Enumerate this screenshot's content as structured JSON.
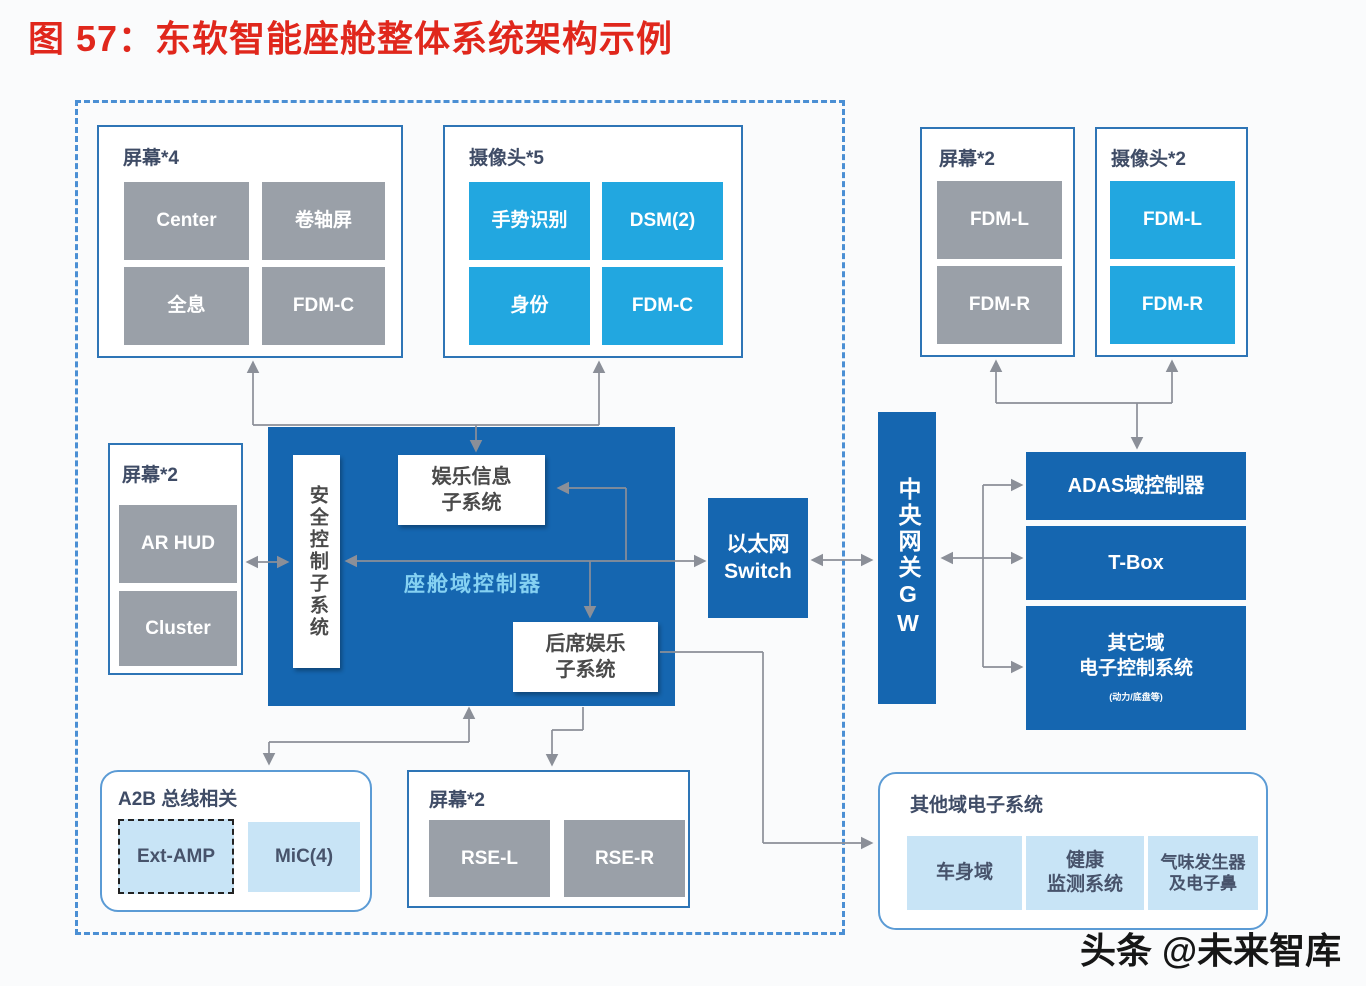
{
  "title": "图 57：东软智能座舱整体系统架构示例",
  "watermark": "头条 @未来智库",
  "colors": {
    "title_red": "#e0271c",
    "domain_blue": "#1566b0",
    "camera_blue": "#22a7e0",
    "screen_gray": "#9aa0a8",
    "light_blue": "#c8e4f6",
    "group_border_blue": "#2e75b6",
    "dashed_border_blue": "#4a8fd4",
    "wire_gray": "#8b8f98"
  },
  "top_left_screens": {
    "label": "屏幕*4",
    "cells": [
      "Center",
      "卷轴屏",
      "全息",
      "FDM-C"
    ]
  },
  "top_cameras": {
    "label": "摄像头*5",
    "cells": [
      "手势识别",
      "DSM(2)",
      "身份",
      "FDM-C"
    ]
  },
  "top_right_screens": {
    "label": "屏幕*2",
    "cells": [
      "FDM-L",
      "FDM-R"
    ]
  },
  "top_right_cameras": {
    "label": "摄像头*2",
    "cells": [
      "FDM-L",
      "FDM-R"
    ]
  },
  "left_screens": {
    "label": "屏幕*2",
    "cells": [
      "AR HUD",
      "Cluster"
    ]
  },
  "cockpit_controller": {
    "label": "座舱域控制器",
    "safety": "安全控制子系统",
    "infotainment": "娱乐信息\n子系统",
    "rear_seat": "后席娱乐\n子系统"
  },
  "ethernet_switch": "以太网\nSwitch",
  "central_gateway": "中央网关GW",
  "adas_controller": "ADAS域控制器",
  "tbox": "T-Box",
  "other_domain_ecu": {
    "line1": "其它域\n电子控制系统",
    "note": "(动力/底盘等)"
  },
  "a2b": {
    "label": "A2B 总线相关",
    "cells": [
      "Ext-AMP",
      "MiC(4)"
    ]
  },
  "bottom_screens": {
    "label": "屏幕*2",
    "cells": [
      "RSE-L",
      "RSE-R"
    ]
  },
  "other_domain_box": {
    "label": "其他域电子系统",
    "cells": [
      "车身域",
      "健康\n监测系统",
      "气味发生器\n及电子鼻"
    ]
  }
}
